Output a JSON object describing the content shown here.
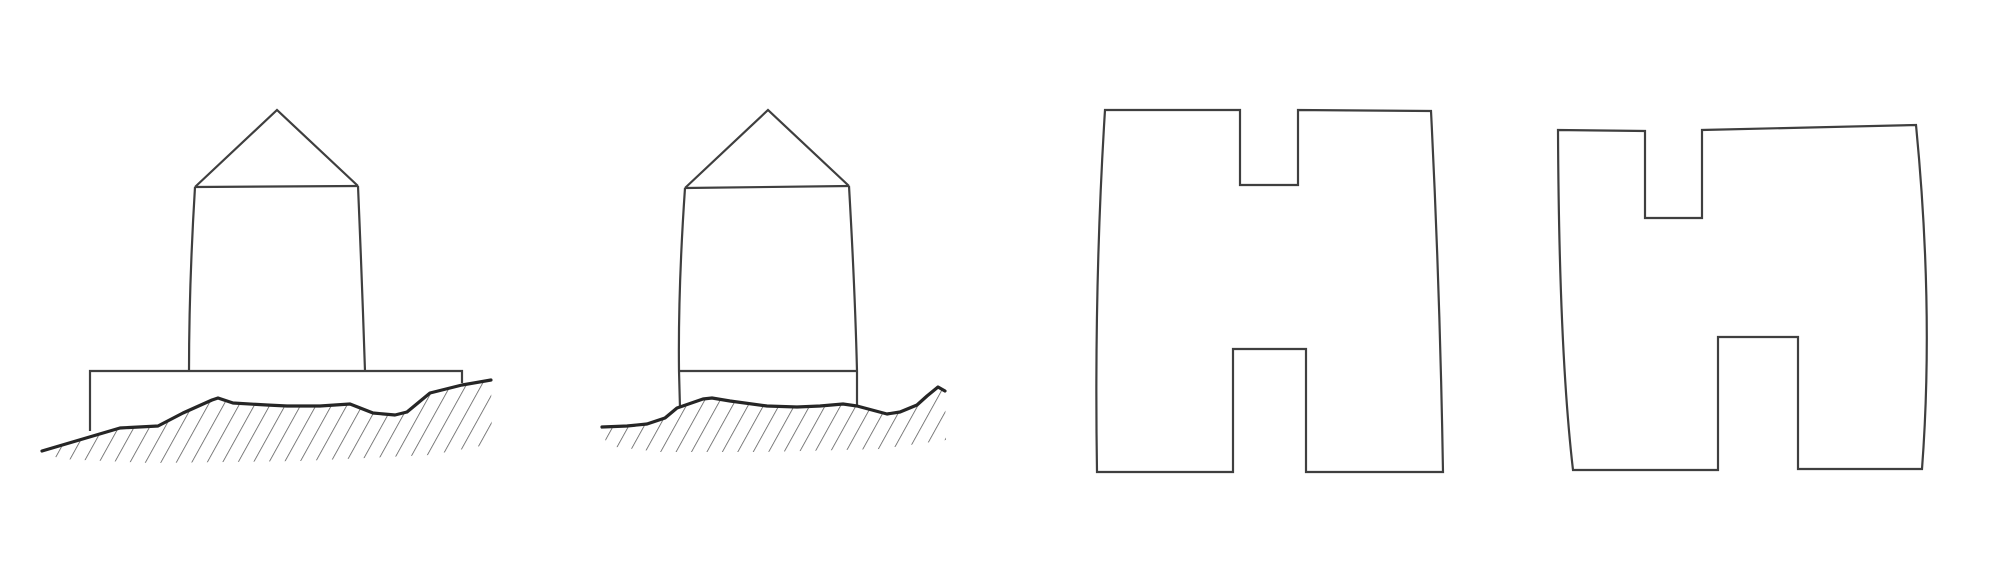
{
  "canvas": {
    "width": 2000,
    "height": 585,
    "background": "#ffffff"
  },
  "style": {
    "outline_color": "#3f3f3f",
    "outline_width": 2.2,
    "ground_color": "#262626",
    "ground_width": 3.2,
    "hatch_color": "#555555",
    "hatch_width": 1.5,
    "hatch_spacing": 13.5,
    "hatch_angle_deg": 29
  },
  "figures": [
    {
      "name": "hut-on-foundation-slab-sketch",
      "parts": [
        {
          "name": "roof-outline",
          "role": "outline",
          "d": "M195,187 L277,110 L358,186"
        },
        {
          "name": "eaves-line",
          "role": "outline",
          "d": "M195,187 L358,186"
        },
        {
          "name": "wall-left",
          "role": "outline",
          "d": "M195,187 Q189,285 189,372"
        },
        {
          "name": "wall-right",
          "role": "outline",
          "d": "M358,186 Q362,280 365,371"
        },
        {
          "name": "foundation-slab",
          "role": "outline",
          "d": "M90,431 L90,371 L462,371 L462,383"
        },
        {
          "name": "ground-hatch",
          "role": "hatch",
          "d": "M42,451 L120,428 L158,426 L183,413 L212,400 L218,398 L233,403 L267,405 L287,406 L320,406 L350,404 L373,413 L395,415 L407,412 L430,393 L450,388 L462,385 L491,380 L492,444 L430,455 L300,461 L150,463 L60,459 Z"
        },
        {
          "name": "ground-line",
          "role": "ground",
          "d": "M42,451 L120,428 L158,426 L183,413 L212,400 L218,398 L233,403 L267,405 L287,406 L320,406 L350,404 L373,413 L395,415 L407,412 L430,393 L450,388 L462,385 L491,380"
        }
      ]
    },
    {
      "name": "hut-on-plinth-sketch",
      "parts": [
        {
          "name": "roof-outline",
          "role": "outline",
          "d": "M685,188 L768,110 L849,186"
        },
        {
          "name": "eaves-line",
          "role": "outline",
          "d": "M685,188 L849,186"
        },
        {
          "name": "wall-left",
          "role": "outline",
          "d": "M685,188 Q678,290 679,371 L680,408"
        },
        {
          "name": "wall-right",
          "role": "outline",
          "d": "M849,186 Q855,290 857,371 L857,406"
        },
        {
          "name": "plinth-line",
          "role": "outline",
          "d": "M679,371 L857,371"
        },
        {
          "name": "ground-hatch",
          "role": "hatch",
          "d": "M602,427 L627,426 L647,424 L665,418 L677,408 L703,399 L712,398 L730,401 L767,406 L797,407 L820,406 L843,404 L857,406 L887,414 L900,412 L917,405 L927,396 L938,387 L945,391 L946,440 L880,449 L760,452 L660,452 L607,446 Z"
        },
        {
          "name": "ground-line",
          "role": "ground",
          "d": "M602,427 L627,426 L647,424 L665,418 L677,408 L703,399 L712,398 L730,401 L767,406 L797,407 L820,406 L843,404 L857,406 L887,414 L900,412 L917,405 L927,396 L938,387 L945,391"
        }
      ]
    },
    {
      "name": "h-shaped-block-sketch-left",
      "parts": [
        {
          "name": "block-outline",
          "role": "outline",
          "d": "M1105,110 L1240,110 L1240,185 L1298,185 L1298,110 L1431,111 Q1440,290 1443,472 L1306,472 L1306,349 L1233,349 L1233,472 L1097,472 Q1094,285 1105,110 Z"
        }
      ]
    },
    {
      "name": "h-shaped-block-sketch-right",
      "parts": [
        {
          "name": "block-outline",
          "role": "outline",
          "d": "M1558,130 L1645,131 L1645,218 L1702,218 L1702,130 L1916,125 Q1934,310 1922,469 L1798,469 L1798,337 L1718,337 L1718,470 L1573,470 Q1559,350 1558,130 Z"
        }
      ]
    }
  ]
}
